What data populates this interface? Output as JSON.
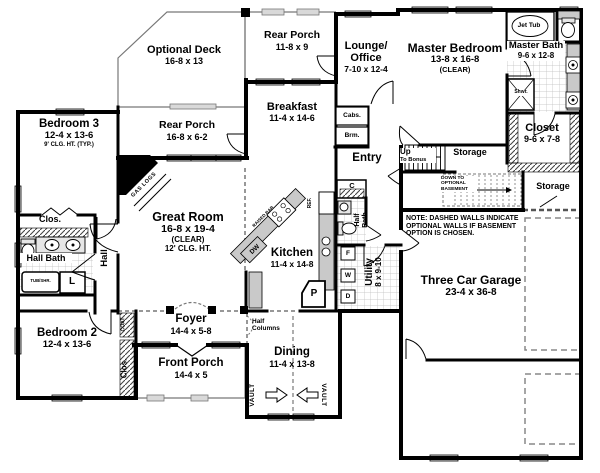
{
  "colors": {
    "wall": "#000000",
    "porch_line": "#777777",
    "window_fill": "#d9d9d9",
    "counter_fill": "#c9c9c9",
    "tile_line": "#bdbdbd",
    "dashed_optional": "#777777",
    "background": "#ffffff"
  },
  "rooms": {
    "optional_deck": {
      "name": "Optional Deck",
      "dims": "16-8 x 13"
    },
    "rear_porch_upper": {
      "name": "Rear Porch",
      "dims": "11-8 x 9"
    },
    "rear_porch_lower": {
      "name": "Rear Porch",
      "dims": "16-8 x 6-2"
    },
    "lounge_office": {
      "name_line1": "Lounge/",
      "name_line2": "Office",
      "dims": "7-10 x 12-4"
    },
    "master_bedroom": {
      "name": "Master Bedroom",
      "dims": "13-8 x 16-8",
      "note": "(CLEAR)"
    },
    "master_bath": {
      "name": "Master Bath",
      "dims": "9-6 x 12-8"
    },
    "master_closet": {
      "name": "Closet",
      "dims": "9-6 x 7-8"
    },
    "storage_upper": {
      "name": "Storage"
    },
    "storage_lower": {
      "name": "Storage"
    },
    "breakfast": {
      "name": "Breakfast",
      "dims": "11-4 x 14-6"
    },
    "great_room": {
      "name": "Great Room",
      "dims": "16-8 x 19-4",
      "note1": "(CLEAR)",
      "note2": "12' CLG. HT."
    },
    "bedroom_3": {
      "name": "Bedroom 3",
      "dims": "12-4 x 13-6",
      "note": "9' CLG. HT. (TYP.)"
    },
    "bedroom_2": {
      "name": "Bedroom 2",
      "dims": "12-4 x 13-6"
    },
    "hall_bath": {
      "name": "Hall Bath"
    },
    "hall": {
      "name": "Hall"
    },
    "kitchen": {
      "name": "Kitchen",
      "dims": "11-4 x 14-8"
    },
    "entry": {
      "name": "Entry"
    },
    "half_bath": {
      "name": "Half Bath"
    },
    "utility": {
      "name": "Utility",
      "dims": "8 x 9-10"
    },
    "garage": {
      "name": "Three Car Garage",
      "dims": "23-4 x 36-8"
    },
    "foyer": {
      "name": "Foyer",
      "dims": "14-4 x 5-8"
    },
    "front_porch": {
      "name": "Front Porch",
      "dims": "14-4 x 5"
    },
    "dining": {
      "name": "Dining",
      "dims": "11-4 x 13-8"
    }
  },
  "stairs": {
    "up": "Up",
    "up_dest": "To Bonus",
    "down": "DOWN TO OPTIONAL BASEMENT"
  },
  "fixtures": {
    "jet_tub": "Jet Tub",
    "shower": "Shwr.",
    "tub_shower": "TUB/SHR.",
    "linen": "L",
    "cabinets": "Cabs.",
    "broom": "Brm.",
    "refrigerator": "REF.",
    "dishwasher": "DW",
    "raised_bar": "RAISED BAR",
    "gas_logs": "GAS LOGS",
    "pantry": "P",
    "coat_closet": "COAT",
    "closet_abbr": "Clos.",
    "closet_letter": "C",
    "freezer": "F",
    "washer": "W",
    "dryer": "D"
  },
  "annotations": {
    "vault": "VAULT",
    "half_columns": "Half Columns",
    "note": "NOTE: DASHED WALLS INDICATE OPTIONAL WALLS IF BASEMENT OPTION IS CHOSEN."
  }
}
